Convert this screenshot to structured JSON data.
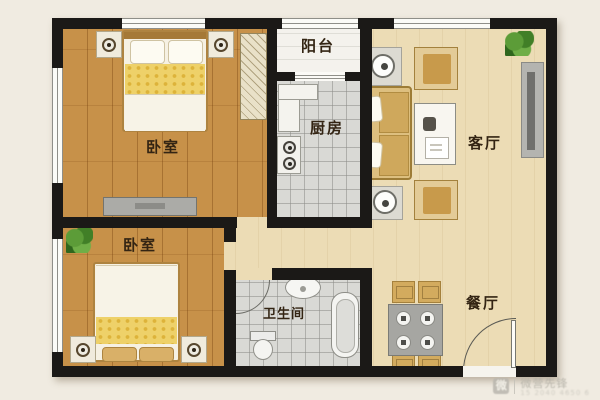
{
  "rooms": {
    "bedroom1": {
      "label": "卧室"
    },
    "bedroom2": {
      "label": "卧室"
    },
    "balcony": {
      "label": "阳台"
    },
    "kitchen": {
      "label": "厨房"
    },
    "living": {
      "label": "客厅"
    },
    "dining": {
      "label": "餐厅"
    },
    "bathroom": {
      "label": "卫生间"
    }
  },
  "watermark": {
    "logo_char": "微",
    "brand": "微营先锋",
    "subtext": "15 2040 4650 6"
  },
  "colors": {
    "wall": "#1b1917",
    "wood_floor": "#c79149",
    "beige_floor": "#ecdcb5",
    "tile_floor": "#d9d9d5",
    "balcony_floor": "#f4f2ed",
    "furniture_tan": "#ddbf7f",
    "bed_yellow": "#eed169",
    "plant_green": "#4d8c2f"
  }
}
